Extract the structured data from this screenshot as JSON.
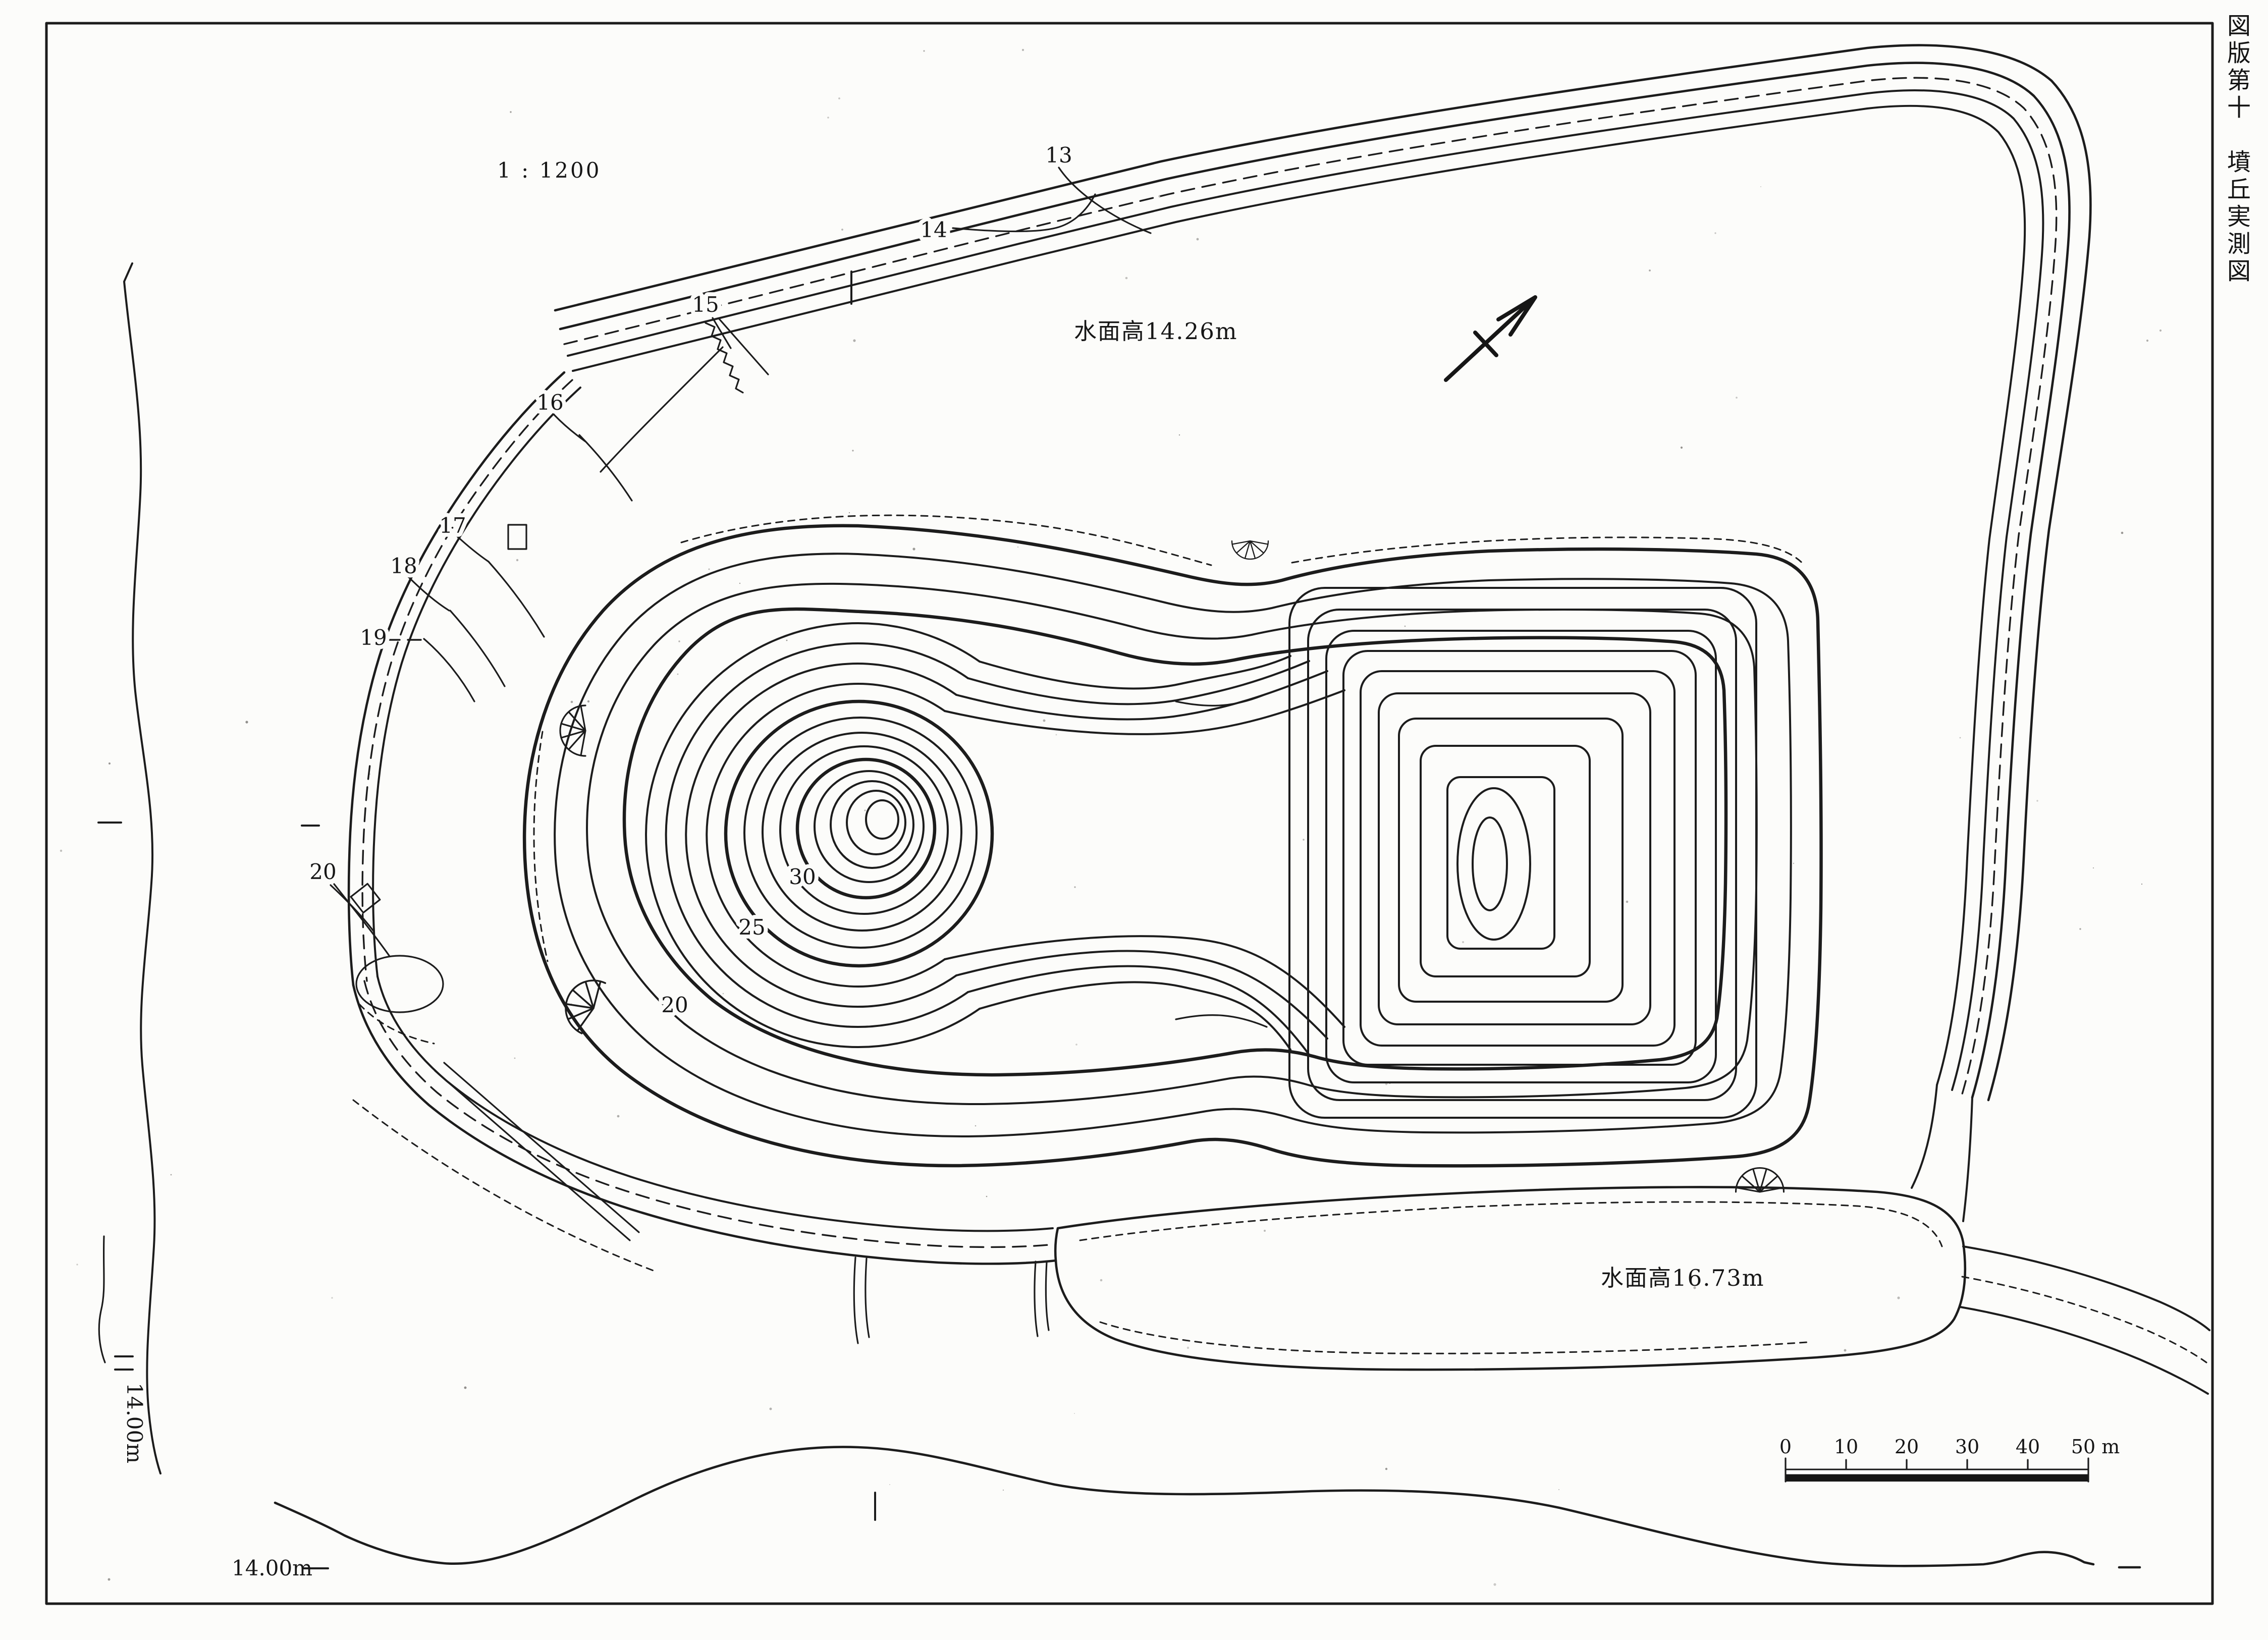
{
  "page": {
    "side_title": "図版第十　墳丘実測図",
    "map_scale": "1 : 1200"
  },
  "water_levels": {
    "moat": "水面高14.26m",
    "south_pond": "水面高16.73m"
  },
  "elevation_marks": {
    "left": "14.00m",
    "bottom": "14.00m"
  },
  "contour_labels": {
    "moat_edge": [
      "13",
      "14",
      "15",
      "16",
      "17",
      "18",
      "19",
      "20"
    ],
    "mound": [
      "30",
      "25",
      "20"
    ]
  },
  "scale_bar": {
    "ticks": [
      "0",
      "10",
      "20",
      "30",
      "40",
      "50 m"
    ]
  },
  "icons": {
    "north_arrow": "north-arrow",
    "survey_marker": "survey-square",
    "scarp": "scarp-hatch-fan"
  }
}
